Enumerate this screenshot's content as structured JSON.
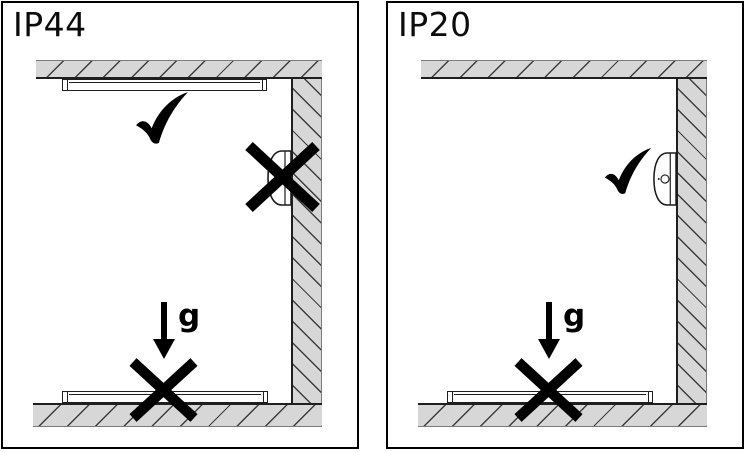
{
  "figure": {
    "type": "luminaire-mounting-orientation-diagram",
    "colors": {
      "background": "#ffffff",
      "surface_fill": "#d7d7d7",
      "hatch_line": "#3d3d3d",
      "panel_border": "#000000",
      "mark_color": "#000000"
    },
    "panels": [
      {
        "rating_label": "IP44",
        "gravity_label": "g",
        "ceiling_mount": "allowed",
        "wall_mount": "not-allowed",
        "floor_mount": "not-allowed"
      },
      {
        "rating_label": "IP20",
        "gravity_label": "g",
        "ceiling_mount": "not-shown",
        "wall_mount": "allowed",
        "floor_mount": "not-allowed"
      }
    ]
  }
}
